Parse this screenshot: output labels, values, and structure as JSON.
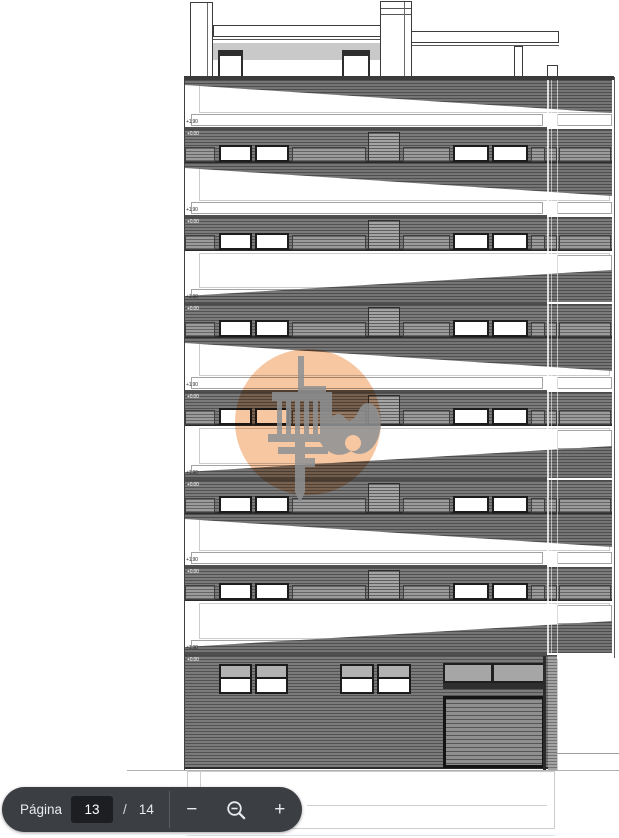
{
  "toolbar": {
    "page_label": "Página",
    "page_current": "13",
    "separator": "/",
    "page_total": "14",
    "zoom_out_minus_label": "−",
    "zoom_in_plus_label": "+",
    "colors": {
      "pill_bg": "#3b3e42",
      "input_bg": "#1d1e21",
      "text": "#e8eaed",
      "divider": "#595c60"
    }
  },
  "drawing": {
    "description_labels": {
      "upper_level": "+1.90",
      "zero_level": "+0.00"
    },
    "floors": [
      {
        "upper_level_label": "+1.90",
        "zero_level_label": "+0.00",
        "wedge": "top",
        "type": "typical"
      },
      {
        "upper_level_label": "+1.90",
        "zero_level_label": "+0.00",
        "wedge": "top",
        "type": "typical"
      },
      {
        "upper_level_label": "+1.90",
        "zero_level_label": "+0.00",
        "wedge": "bottom",
        "type": "typical"
      },
      {
        "upper_level_label": "+1.90",
        "zero_level_label": "+0.00",
        "wedge": "top",
        "type": "typical"
      },
      {
        "upper_level_label": "+1.90",
        "zero_level_label": "+0.00",
        "wedge": "bottom",
        "type": "typical"
      },
      {
        "upper_level_label": "+1.90",
        "zero_level_label": "+0.00",
        "wedge": "top",
        "type": "typical"
      },
      {
        "upper_level_label": "+1.90",
        "zero_level_label": "+0.00",
        "wedge": "bottom",
        "type": "ground"
      }
    ],
    "colors": {
      "facade_band": "#7b7b7b",
      "hatch_line": "#2b2b2b",
      "roof_gray": "#c9c9c9",
      "window_frame": "#1c1c1c",
      "ground_pane_gray": "#b2b2b2"
    }
  },
  "watermark": {
    "circle_color": "#f4b483",
    "icon_color": "#8e9194",
    "icon_names": [
      "caliper-column-icon",
      "wave-icon"
    ]
  }
}
